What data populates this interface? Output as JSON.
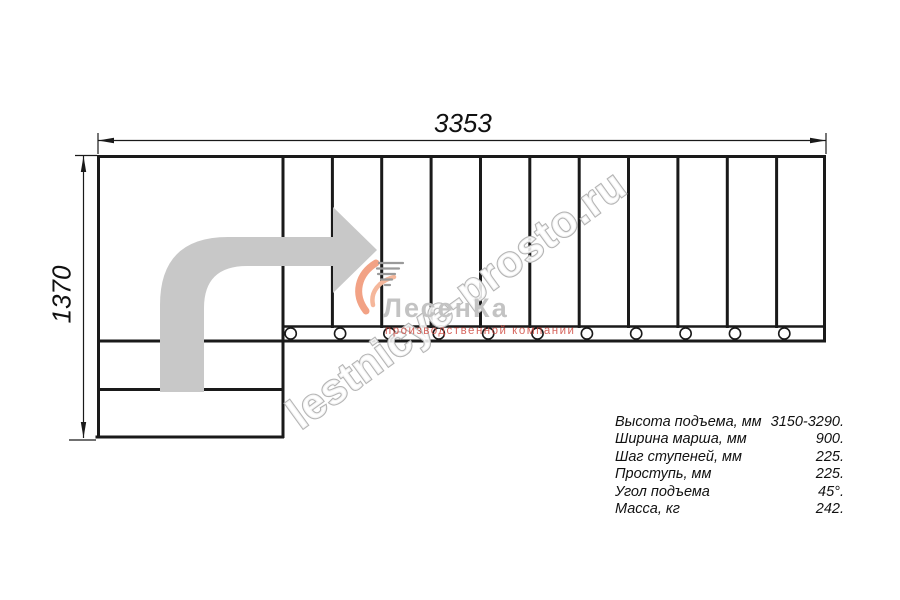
{
  "drawing": {
    "dim_width_label": "3353",
    "dim_height_label": "1370",
    "watermark_text": "lestnicye-prosto.ru",
    "logo": {
      "name": "ЛесенКа",
      "tagline": "производственной компании",
      "accent_color": "#f2a285",
      "tagline_color": "#cf4b42"
    },
    "line_color": "#1a1a1a",
    "arrow_color": "#c8c8c8",
    "watermark_color": "#b5b5b5"
  },
  "specs": {
    "rows": [
      {
        "label": "Высота подъема, мм",
        "value": "3150-3290."
      },
      {
        "label": "Ширина марша, мм",
        "value": "900."
      },
      {
        "label": "Шаг ступеней, мм",
        "value": "225."
      },
      {
        "label": "Проступь, мм",
        "value": "225."
      },
      {
        "label": "Угол подъема",
        "value": "45°."
      },
      {
        "label": "Масса, кг",
        "value": "242."
      }
    ]
  }
}
